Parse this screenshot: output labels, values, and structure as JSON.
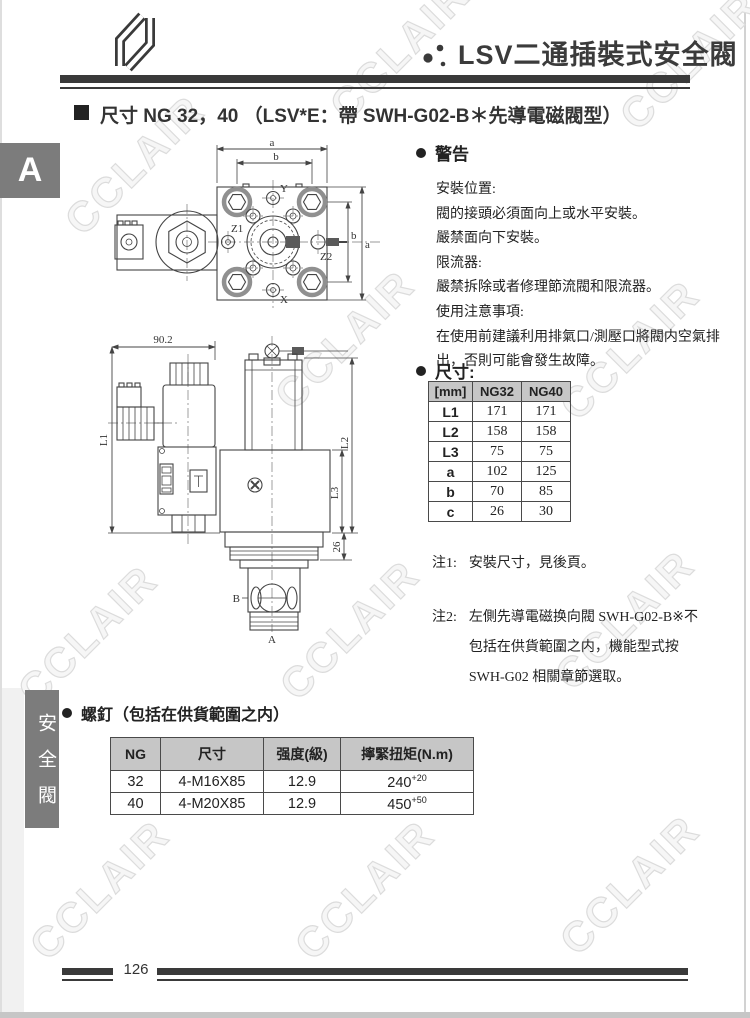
{
  "watermark": "CCLAIR",
  "header": {
    "title": "LSV二通插裝式安全閥"
  },
  "section_heading": "尺寸 NG 32，40 （LSV*E：帶 SWH-G02-B＊先導電磁閥型）",
  "tab_letter": "A",
  "side_tab": "安全閥",
  "warning": {
    "title": "警告",
    "lines": [
      "安裝位置:",
      "閥的接頭必須面向上或水平安裝。",
      "嚴禁面向下安裝。",
      "限流器:",
      "嚴禁拆除或者修理節流閥和限流器。",
      "使用注意事項:",
      "在使用前建議利用排氣口/測壓口將閥内空氣排",
      "出，否則可能會發生故障。"
    ]
  },
  "dims": {
    "title": "尺寸:",
    "table": {
      "headers": [
        "[mm]",
        "NG32",
        "NG40"
      ],
      "rows": [
        {
          "label": "L1",
          "ng32": "171",
          "ng40": "171"
        },
        {
          "label": "L2",
          "ng32": "158",
          "ng40": "158"
        },
        {
          "label": "L3",
          "ng32": "75",
          "ng40": "75"
        },
        {
          "label": "a",
          "ng32": "102",
          "ng40": "125"
        },
        {
          "label": "b",
          "ng32": "70",
          "ng40": "85"
        },
        {
          "label": "c",
          "ng32": "26",
          "ng40": "30"
        }
      ]
    },
    "note1_label": "注1:",
    "note1": "安裝尺寸，見後頁。",
    "note2_label": "注2:",
    "note2_lines": [
      "左側先導電磁换向閥 SWH-G02-B※不",
      "包括在供貨範圍之内，機能型式按",
      "SWH-G02 相關章節選取。"
    ]
  },
  "screws": {
    "title": "螺釘（包括在供貨範圍之内）",
    "table": {
      "headers": [
        "NG",
        "尺寸",
        "强度(級)",
        "擰緊扭矩(N.m)"
      ],
      "rows": [
        {
          "ng": "32",
          "size": "4-M16X85",
          "grade": "12.9",
          "torque": "240",
          "torque_sup": "+20"
        },
        {
          "ng": "40",
          "size": "4-M20X85",
          "grade": "12.9",
          "torque": "450",
          "torque_sup": "+50"
        }
      ]
    }
  },
  "drawing_top": {
    "labels": {
      "a_top": "a",
      "b_top": "b",
      "b_right": "b",
      "a_right": "a",
      "y": "Y",
      "x": "X",
      "z1": "Z1",
      "z2": "Z2"
    }
  },
  "drawing_side": {
    "labels": {
      "w": "90.2",
      "l1": "L1",
      "l2": "L2",
      "l3": "L3",
      "d26": "26",
      "b": "B",
      "a": "A"
    }
  },
  "footer": {
    "page": "126"
  },
  "colors": {
    "tab_gray": "#7c7c7c",
    "table_header_gray": "#c6c6c6",
    "rule_dark": "#3a3a3a",
    "watermark_stroke": "#dcdcdc"
  }
}
